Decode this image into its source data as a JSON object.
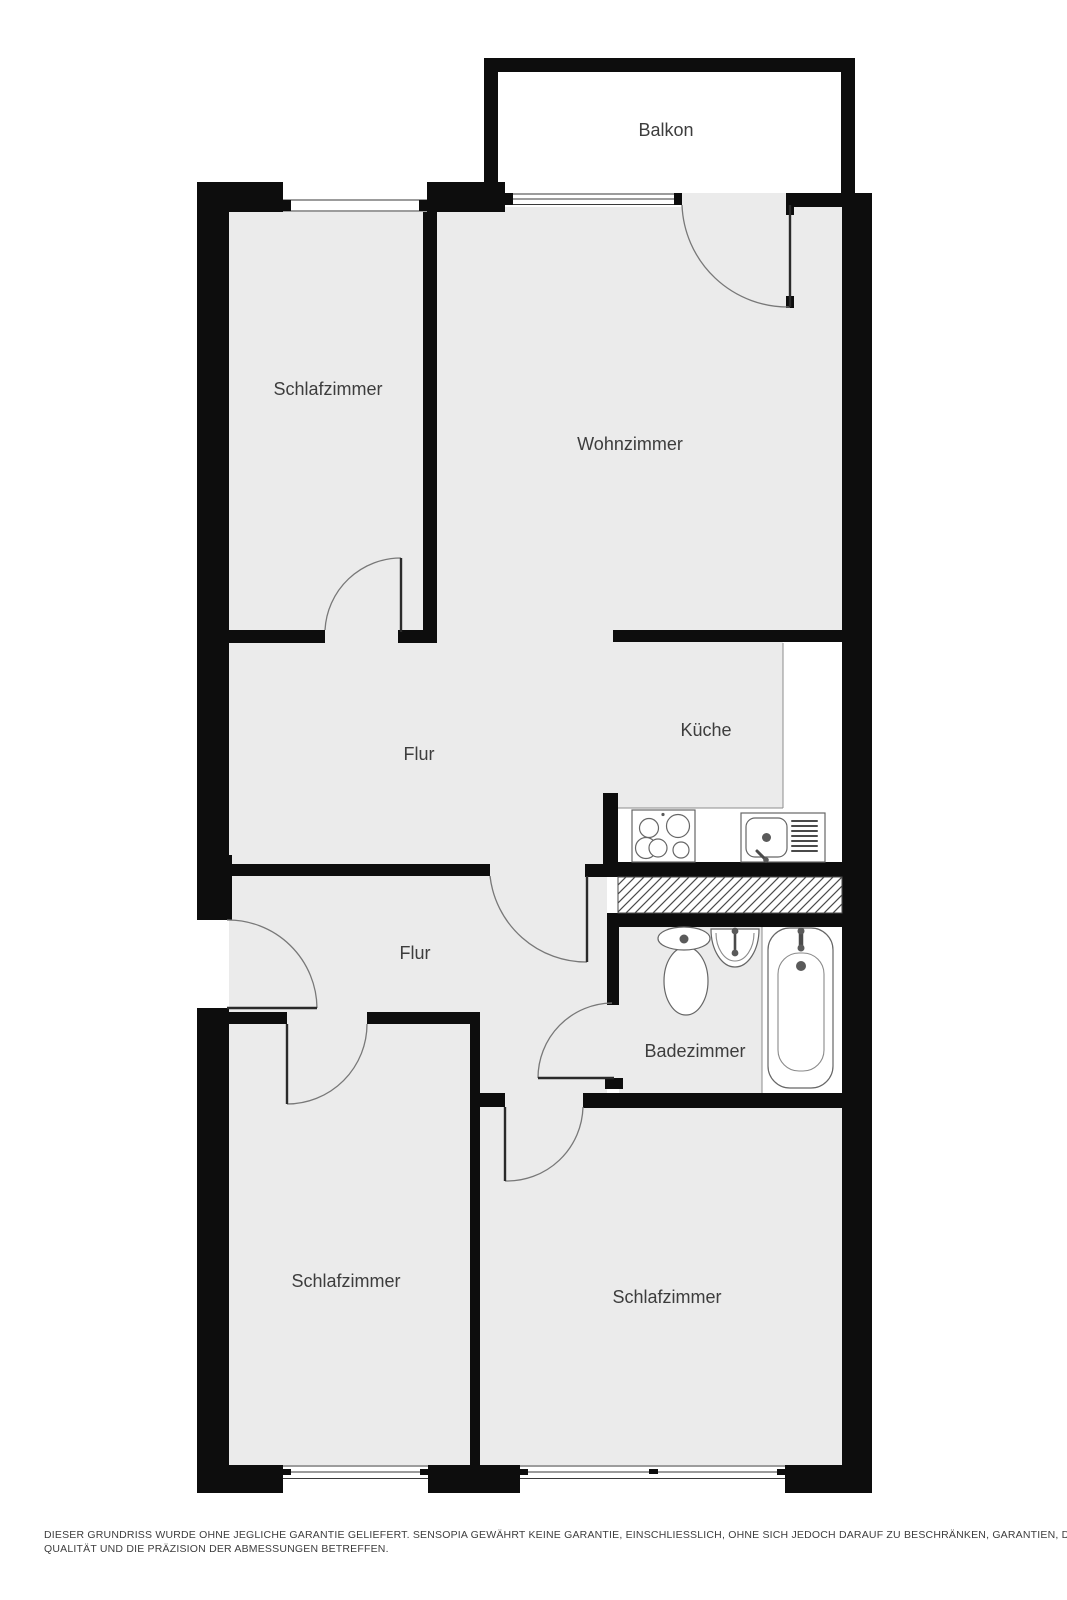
{
  "colors": {
    "floor": "#ebebeb",
    "wall": "#0d0d0d",
    "thin_line": "#8c8c8c",
    "fixture_stroke": "#666666",
    "label_text": "#3d3d3d"
  },
  "rooms": {
    "balkon": {
      "label": "Balkon"
    },
    "schlafzimmer_top_left": {
      "label": "Schlafzimmer"
    },
    "wohnzimmer": {
      "label": "Wohnzimmer"
    },
    "flur_upper": {
      "label": "Flur"
    },
    "kueche": {
      "label": "Küche"
    },
    "flur_lower": {
      "label": "Flur"
    },
    "badezimmer": {
      "label": "Badezimmer"
    },
    "schlafzimmer_bottom_left": {
      "label": "Schlafzimmer"
    },
    "schlafzimmer_bottom_right": {
      "label": "Schlafzimmer"
    }
  },
  "icons": {
    "stove": "stove-icon",
    "kitchen_sink": "kitchen-sink-icon",
    "toilet": "toilet-icon",
    "washbasin": "washbasin-icon",
    "bathtub": "bathtub-icon",
    "duct": "duct-hatch"
  },
  "disclaimer": {
    "line1": "DIESER GRUNDRISS WURDE OHNE JEGLICHE GARANTIE GELIEFERT. SENSOPIA GEWÄHRT KEINE GARANTIE, EINSCHLIESSLICH, OHNE SICH JEDOCH DARAUF ZU BESCHRÄNKEN, GARANTIEN, DIE DIE",
    "line2": "QUALITÄT UND DIE PRÄZISION DER ABMESSUNGEN BETREFFEN."
  }
}
